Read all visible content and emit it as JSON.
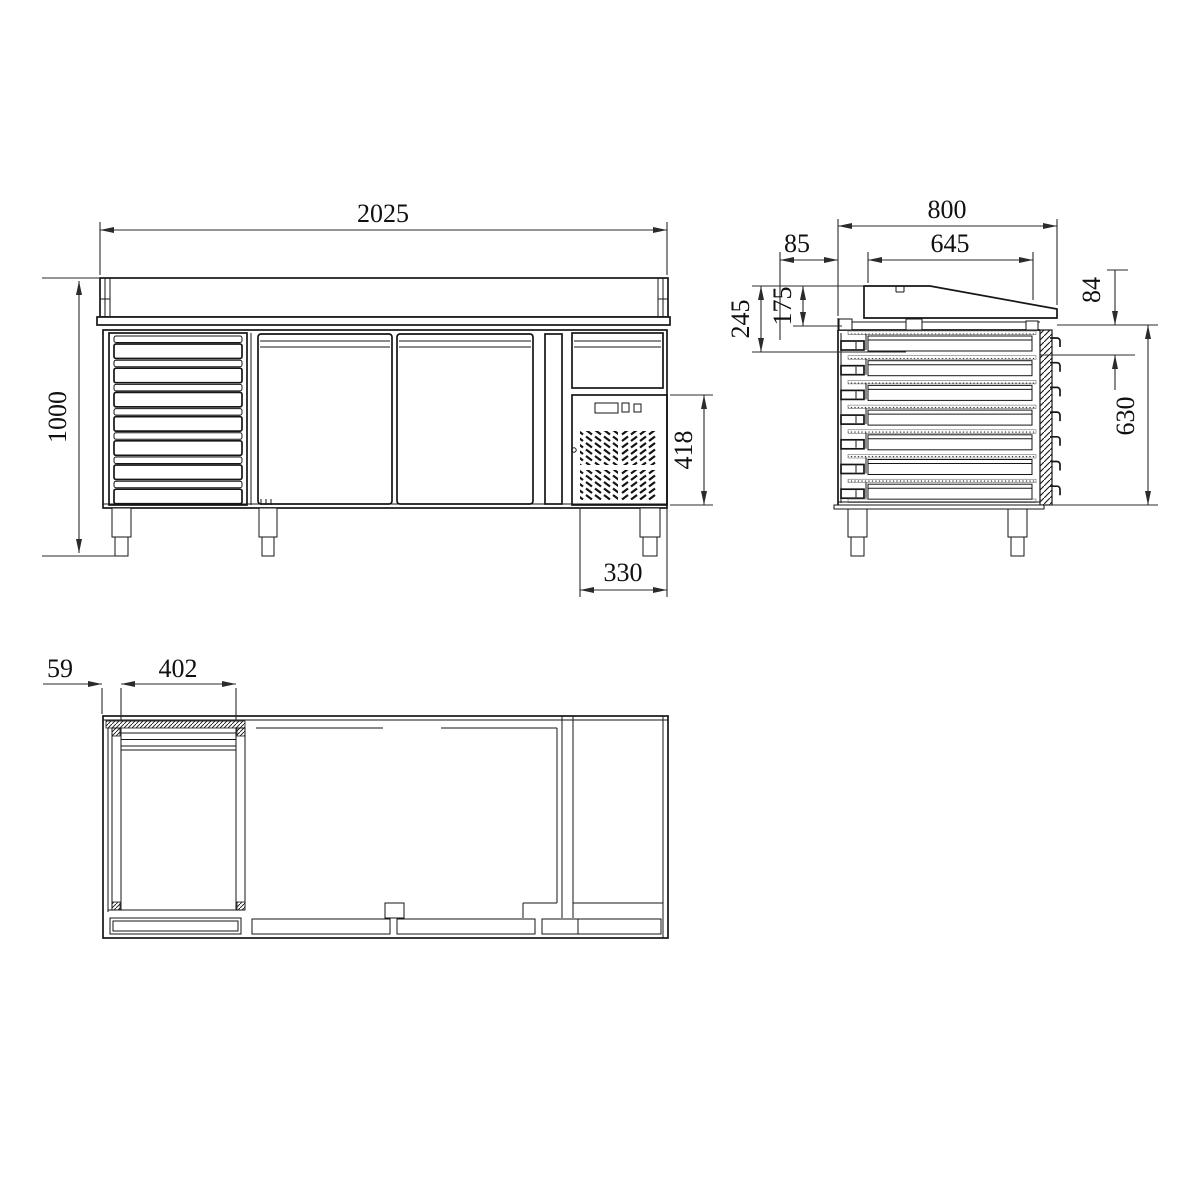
{
  "drawing": {
    "type": "technical-orthographic-drawing",
    "subject": "refrigerated-counter-with-drawers",
    "colors": {
      "line": "#161616",
      "background": "#ffffff"
    },
    "dims": {
      "front_width": "2025",
      "front_height": "1000",
      "condenser_height": "418",
      "condenser_width": "330",
      "side_depth": "800",
      "side_top_depth": "645",
      "side_overhang": "85",
      "side_top_height": "245",
      "side_riser_height": "175",
      "side_step": "84",
      "side_body_height": "630",
      "plan_wall_offset": "59",
      "plan_drawer_width": "402"
    }
  }
}
